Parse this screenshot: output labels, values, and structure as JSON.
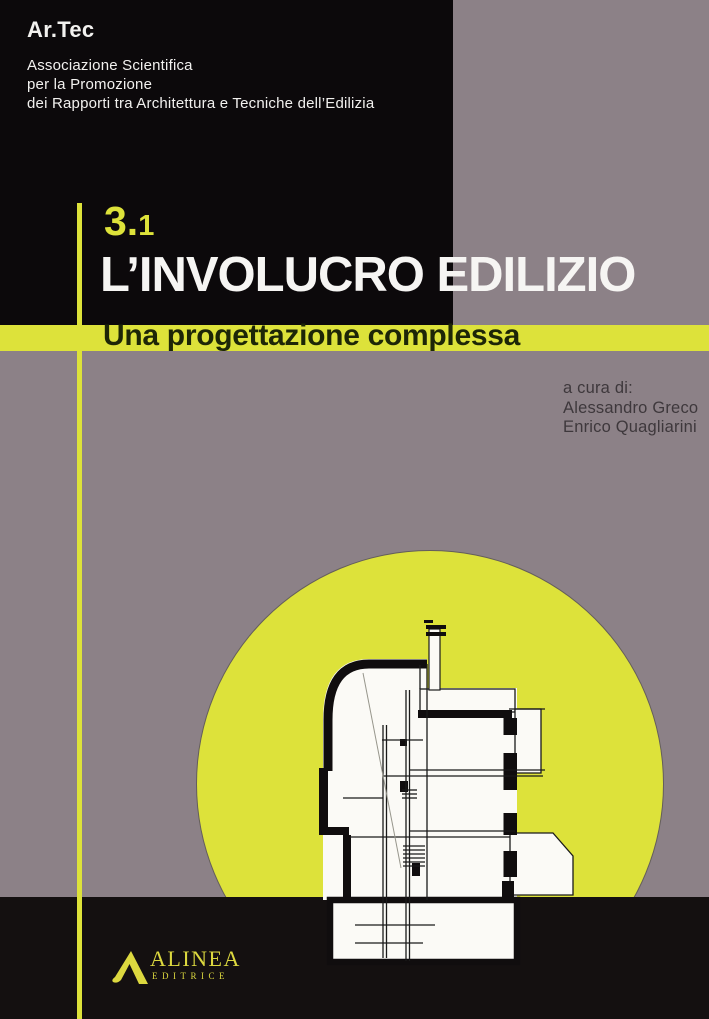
{
  "colors": {
    "grey": "#8c8187",
    "black-top": "#0c090b",
    "black-band": "#141010",
    "yellow": "#dde23a",
    "title-white": "#f6f5f3",
    "subtitle-ink": "#1d2607",
    "editors-ink": "#3e383c",
    "logo-yellow": "#dcd83f",
    "draw-ink": "#1a1a1a"
  },
  "association": {
    "name": "Ar.Tec",
    "lines": [
      "Associazione Scientifica",
      "per la Promozione",
      "dei Rapporti tra Architettura e Tecniche dell’Edilizia"
    ]
  },
  "chapter": {
    "major": "3.",
    "minor": "1"
  },
  "title": "L’INVOLUCRO EDILIZIO",
  "subtitle": "Una progettazione complessa",
  "editors": {
    "label": "a cura di:",
    "names": [
      "Alessandro Greco",
      "Enrico Quagliarini"
    ]
  },
  "publisher": {
    "name": "ALINEA",
    "subname": "EDITRICE"
  },
  "icons": {
    "alinea_mark": "stylized-triangle-A",
    "illustration": "building-section-sketch-in-yellow-sun"
  }
}
